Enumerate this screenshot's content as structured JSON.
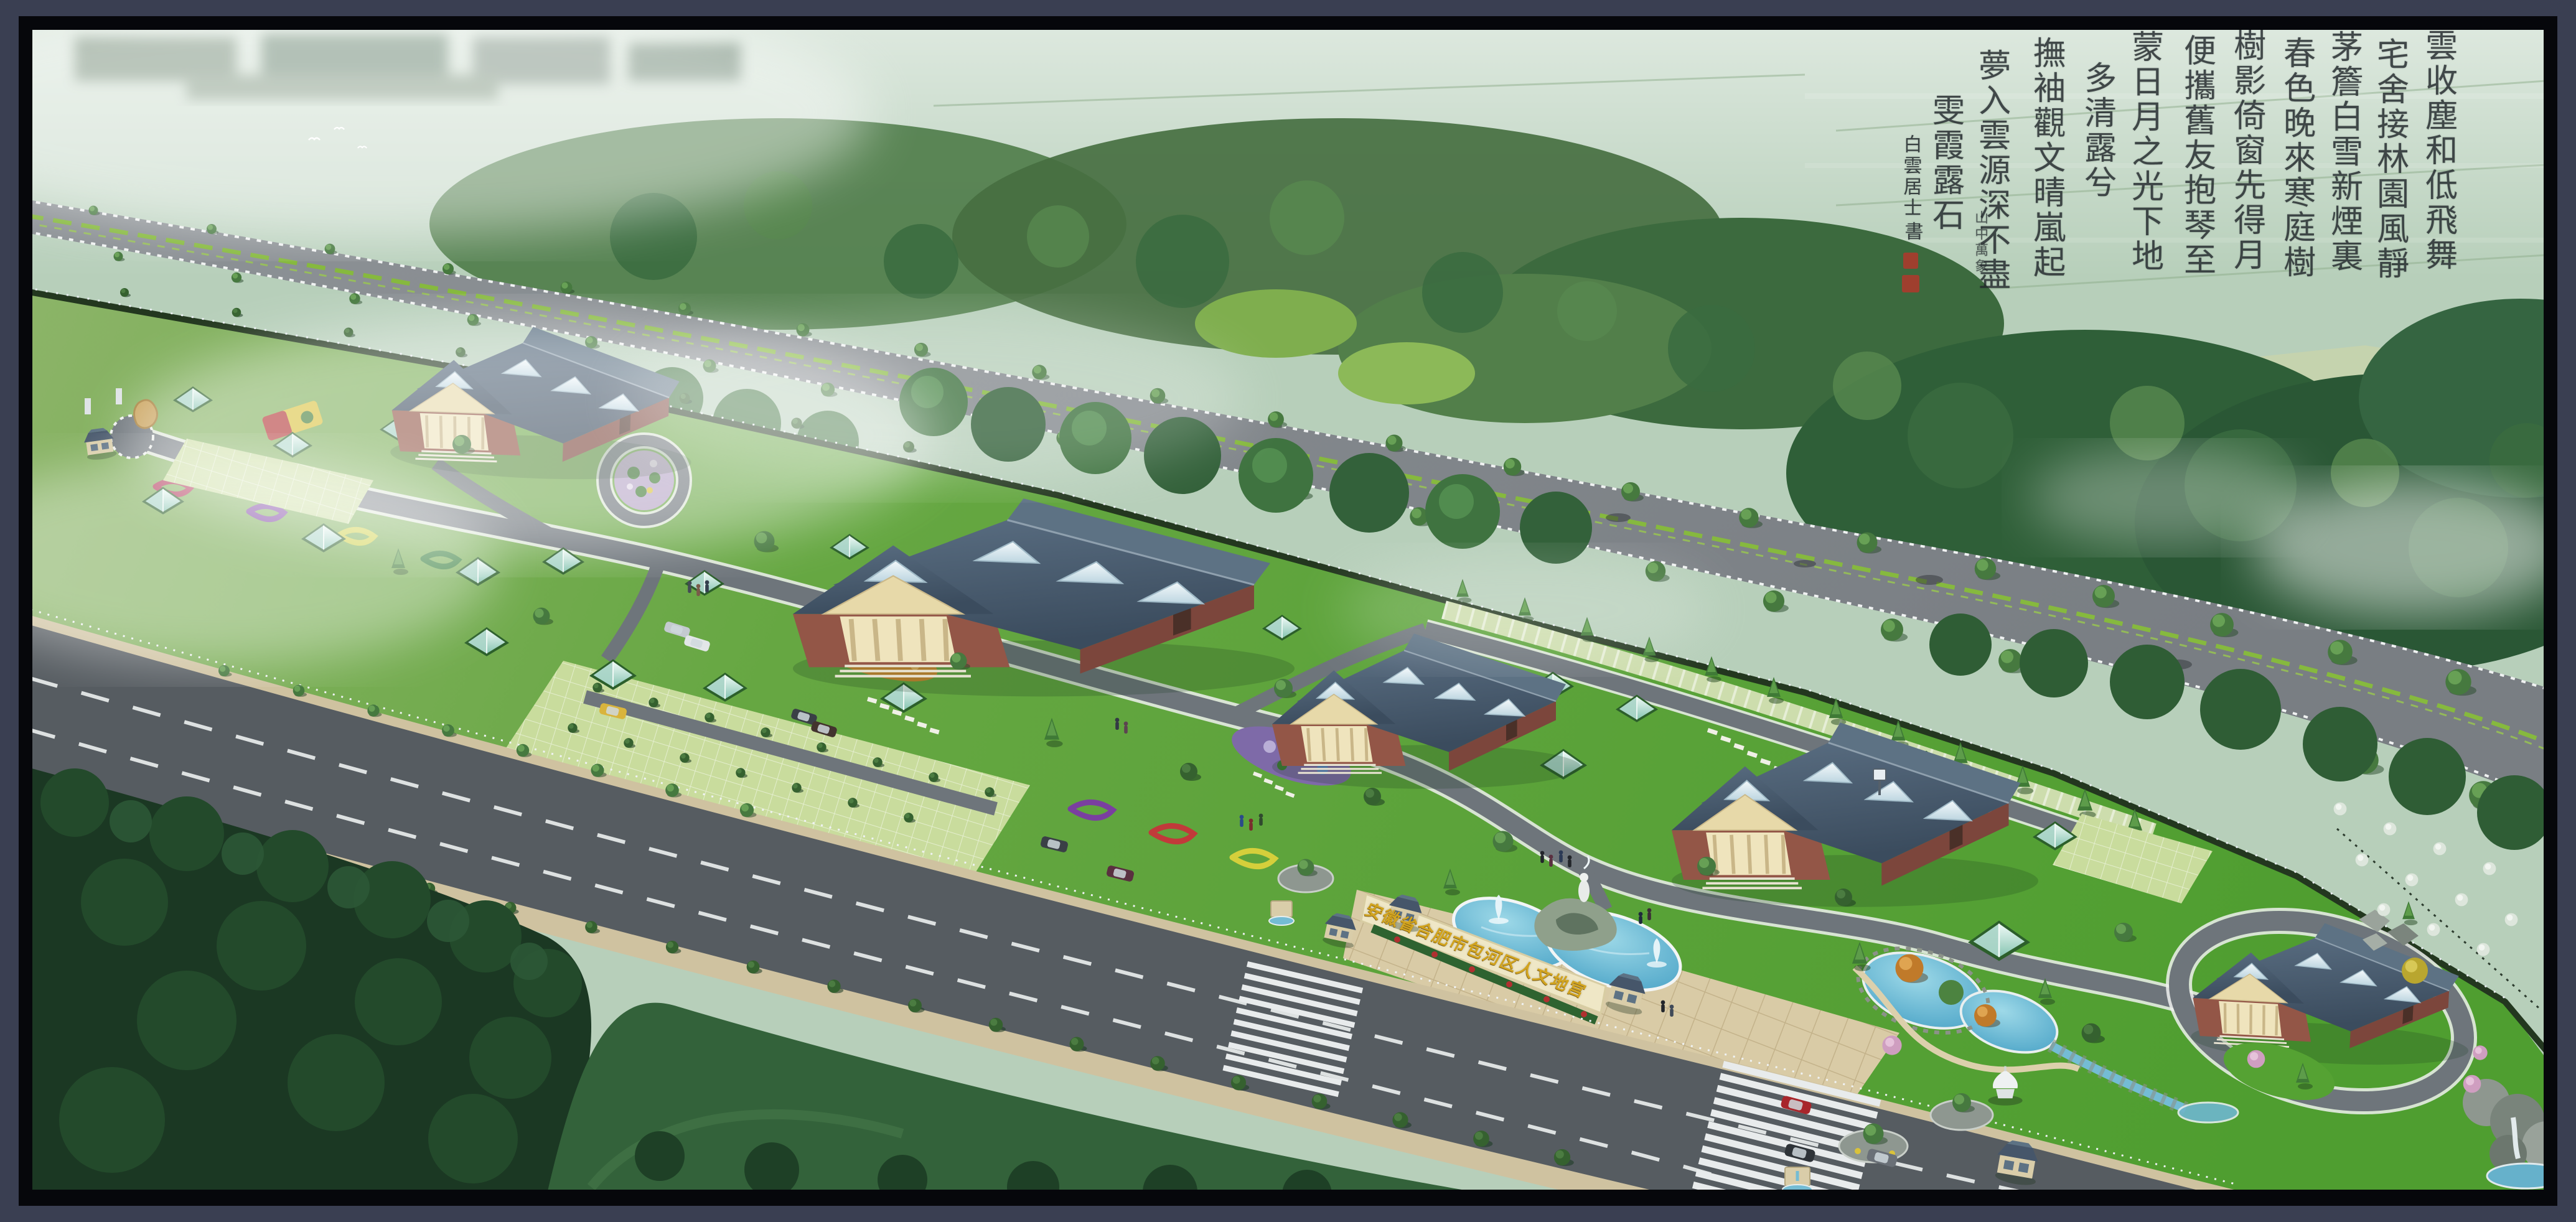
{
  "scene": {
    "description_label": "aerial master-plan rendering",
    "sign": {
      "text": "安徽省合肥市包河区人文地宫"
    },
    "calligraphy": {
      "columns": [
        "雲收塵和低飛舞",
        "宅舍接林園風靜",
        "茅簷白雪新煙裏",
        "春色晚來寒庭樹",
        "樹影倚窗先得月",
        "便攜舊友抱琴至",
        "蒙日月之光下地",
        "多清露兮",
        "撫袖觀文晴嵐起",
        "夢入雲源深不盡",
        "雯霞露石"
      ],
      "signature": "白雲居士",
      "signature_mark": "書",
      "note": "山中萬象"
    }
  },
  "palette": {
    "frame_outer": "#3a3f52",
    "frame_inner": "#06070b",
    "haze_field": "#b7cfba",
    "forest_dark": "#2d5a33",
    "forest_mid": "#3c6d3b",
    "site_lawn": "#5ba235",
    "highway": "#878c90",
    "road_main": "#565c61",
    "road_inner": "#6e757b",
    "sidewalk": "#cfc2a0",
    "plaza_paving": "#d9cba6",
    "pool_water": "#3f9cc2",
    "roof": "#45566a",
    "roof_light": "#5d7284",
    "skylight": "#e4eef2",
    "brick": "#7c463c",
    "brick_light": "#935647",
    "portico": "#e7d9a9",
    "hedge": "#2e6330",
    "gold_text": "#d2a41f",
    "ink": "#20262a",
    "seal_red": "#b0372b",
    "median_green": "#86b93e",
    "foreground_forest": "#1b3823"
  }
}
